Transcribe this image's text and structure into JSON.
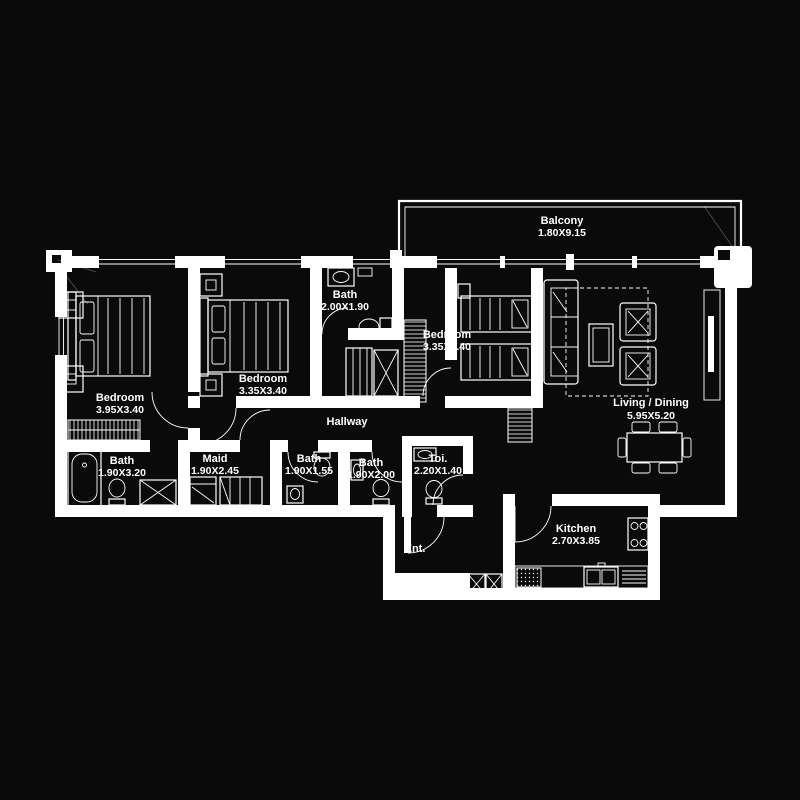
{
  "canvas": {
    "background": "#0a0a0a",
    "line_color": "#ffffff"
  },
  "plan": {
    "type": "apartment-floor-plan",
    "rooms": [
      {
        "id": "balcony",
        "name": "Balcony",
        "dims": "1.80X9.15"
      },
      {
        "id": "bedroom-left",
        "name": "Bedroom",
        "dims": "3.95X3.40"
      },
      {
        "id": "bedroom-middle",
        "name": "Bedroom",
        "dims": "3.35X3.40"
      },
      {
        "id": "bath-top",
        "name": "Bath",
        "dims": "2.00X1.90"
      },
      {
        "id": "bedroom-right",
        "name": "Bedroom",
        "dims": "3.35X3.40"
      },
      {
        "id": "living-dining",
        "name": "Living / Dining",
        "dims": "5.95X5.20"
      },
      {
        "id": "hallway",
        "name": "Hallway",
        "dims": ""
      },
      {
        "id": "bath-left",
        "name": "Bath",
        "dims": "1.90X3.20"
      },
      {
        "id": "maid",
        "name": "Maid",
        "dims": "1.90X2.45"
      },
      {
        "id": "bath-middle",
        "name": "Bath",
        "dims": "1.90X1.55"
      },
      {
        "id": "bath-right",
        "name": "Bath",
        "dims": "1.90X2.00"
      },
      {
        "id": "toilet",
        "name": "Toi.",
        "dims": "2.20X1.40"
      },
      {
        "id": "entrance",
        "name": "Ent.",
        "dims": ""
      },
      {
        "id": "kitchen",
        "name": "Kitchen",
        "dims": "2.70X3.85"
      }
    ]
  }
}
